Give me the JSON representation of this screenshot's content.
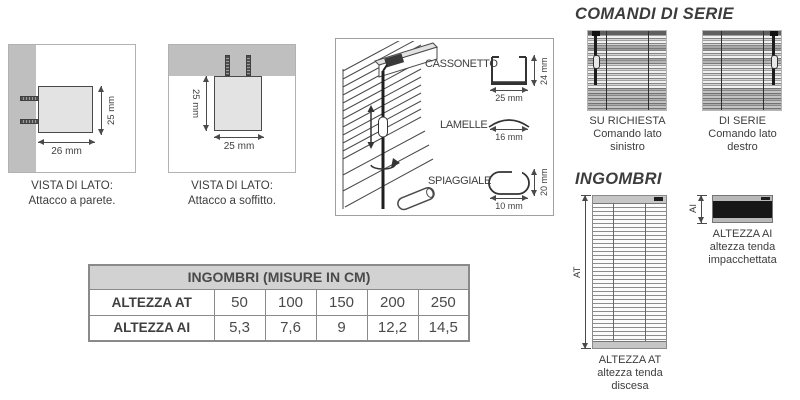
{
  "side_views": {
    "wall": {
      "title": "VISTA DI LATO:",
      "subtitle": "Attacco a parete.",
      "width_label": "26 mm",
      "height_label": "25 mm"
    },
    "ceiling": {
      "title": "VISTA DI LATO:",
      "subtitle": "Attacco a soffitto.",
      "width_label": "25 mm",
      "height_label": "25 mm"
    }
  },
  "components": {
    "cassonetto": {
      "label": "CASSONETTO",
      "width_label": "25 mm",
      "height_label": "24 mm"
    },
    "lamelle": {
      "label": "LAMELLE",
      "width_label": "16 mm"
    },
    "spiaggiale": {
      "label": "SPIAGGIALE",
      "width_label": "10 mm",
      "height_label": "20 mm"
    }
  },
  "table": {
    "title": "INGOMBRI (MISURE IN CM)",
    "row_at": {
      "label": "ALTEZZA AT",
      "values": [
        "50",
        "100",
        "150",
        "200",
        "250"
      ]
    },
    "row_ai": {
      "label": "ALTEZZA AI",
      "values": [
        "5,3",
        "7,6",
        "9",
        "12,2",
        "14,5"
      ]
    }
  },
  "comandi": {
    "title": "COMANDI DI SERIE",
    "left": {
      "lines": [
        "SU RICHIESTA",
        "Comando lato",
        "sinistro"
      ]
    },
    "right": {
      "lines": [
        "DI SERIE",
        "Comando lato",
        "destro"
      ]
    }
  },
  "ingombri": {
    "title": "INGOMBRI",
    "at": {
      "dim_label": "AT",
      "caption": [
        "ALTEZZA AT",
        "altezza tenda",
        "discesa"
      ]
    },
    "ai": {
      "dim_label": "AI",
      "caption": [
        "ALTEZZA AI",
        "altezza tenda",
        "impacchettata"
      ]
    }
  },
  "colors": {
    "surface_gray": "#bfbfbf",
    "table_header_bg": "#d2d2d2",
    "line": "#4a4a4a",
    "packed_blind": "#161616"
  }
}
